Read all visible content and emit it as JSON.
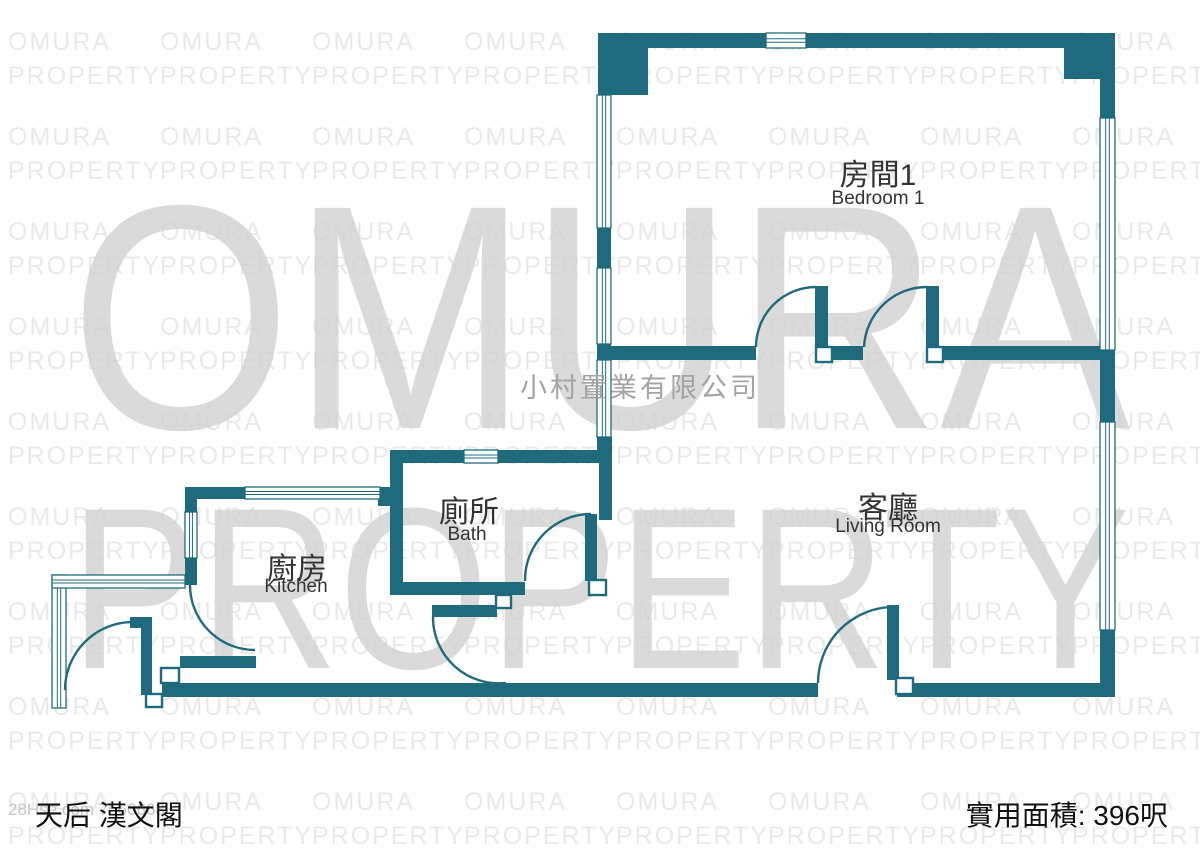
{
  "colors": {
    "wall": "#1f6b7d",
    "tile": "#e9e9e9",
    "big": "#d2d2d2",
    "company": "#a3a3a3",
    "label": "#333333",
    "footer": "#111111",
    "ref": "#c5c5c5"
  },
  "watermark": {
    "line1": "OMURA",
    "line2": "PROPERTY",
    "company": "小村置業有限公司"
  },
  "rooms": [
    {
      "id": "bedroom1",
      "zh": "房間1",
      "en": "Bedroom 1"
    },
    {
      "id": "living-room",
      "zh": "客廳",
      "en": "Living Room"
    },
    {
      "id": "bath",
      "zh": "廁所",
      "en": "Bath"
    },
    {
      "id": "kitchen",
      "zh": "廚房",
      "en": "Kitchen"
    }
  ],
  "footer": {
    "estate_name": "天后 漢文閣",
    "area_label": "實用面積: 396呎",
    "listing_ref": "28Hse.com 7560668"
  }
}
